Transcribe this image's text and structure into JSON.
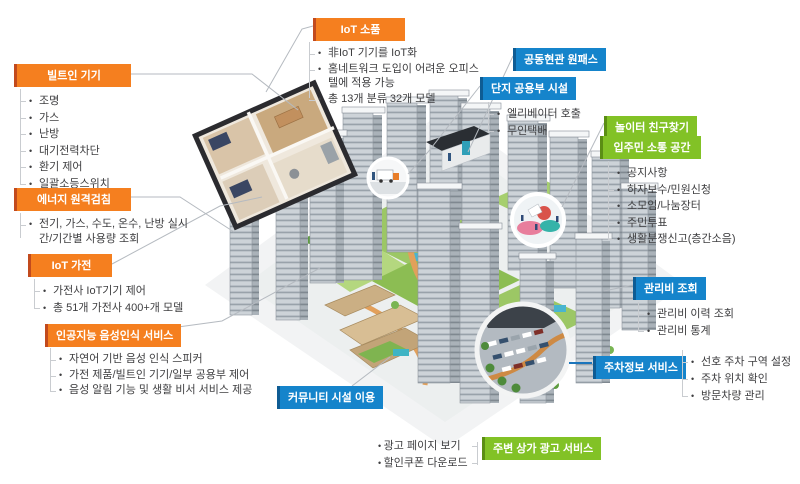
{
  "colors": {
    "orange": "#F57F1F",
    "orange_edge": "#C24A1D",
    "blue": "#1584CB",
    "blue_edge": "#0E5C94",
    "green": "#82C226",
    "green_edge": "#5B8E14",
    "text": "#3E3E40",
    "connector": "#B5BAC0",
    "parking_connector": "#1B75BC"
  },
  "callouts": {
    "builtin": {
      "title": "빌트인 기기",
      "items": [
        "조명",
        "가스",
        "난방",
        "대기전력차단",
        "환기 제어",
        "일괄소등스위치"
      ]
    },
    "energy": {
      "title": "에너지 원격검침",
      "items": [
        "전기, 가스, 수도, 온수, 난방 실시간/기간별 사용량 조회"
      ]
    },
    "iot_appliance": {
      "title": "IoT 가전",
      "items": [
        "가전사 IoT기기 제어",
        "총 51개 가전사 400+개 모델"
      ]
    },
    "ai_voice": {
      "title": "인공지능 음성인식 서비스",
      "items": [
        "자연어 기반 음성 인식 스피커",
        "가전 제품/빌트인 기기/일부 공용부 제어",
        "음성 알림 기능 및 생활 비서 서비스 제공"
      ]
    },
    "iot_small": {
      "title": "IoT 소품",
      "items": [
        "非IoT 기기를 IoT화",
        "홈네트워크 도입이 어려운 오피스텔에 적용 가능",
        "총 13개 분류 32개 모델"
      ]
    },
    "onepass": {
      "title": "공동현관 원패스",
      "items": []
    },
    "complex_common": {
      "title": "단지 공용부 시설",
      "items": [
        "엘리베이터 호출",
        "무인택배"
      ]
    },
    "playground": {
      "title": "놀이터 친구찾기",
      "items": []
    },
    "resident_comm": {
      "title": "입주민 소통 공간",
      "items": [
        "공지사항",
        "하자보수/민원신청",
        "소모임/나눔장터",
        "주민투표",
        "생활분쟁신고(층간소음)"
      ]
    },
    "mgmt_fee": {
      "title": "관리비 조회",
      "items": [
        "관리비 이력 조회",
        "관리비 통계"
      ]
    },
    "parking": {
      "title": "주차정보 서비스",
      "items": [
        "선호 주차 구역 설정",
        "주차 위치 확인",
        "방문차량 관리"
      ]
    },
    "community": {
      "title": "커뮤니티 시설 이용",
      "items": []
    },
    "store_ad": {
      "title": "주변 상가 광고 서비스",
      "items": [
        "광고 페이지 보기",
        "할인쿠폰 다운로드"
      ]
    }
  },
  "illustration": {
    "insets": [
      "floor-plan",
      "delivery-truck",
      "entrance-lobby",
      "playground",
      "parking-lot"
    ]
  }
}
